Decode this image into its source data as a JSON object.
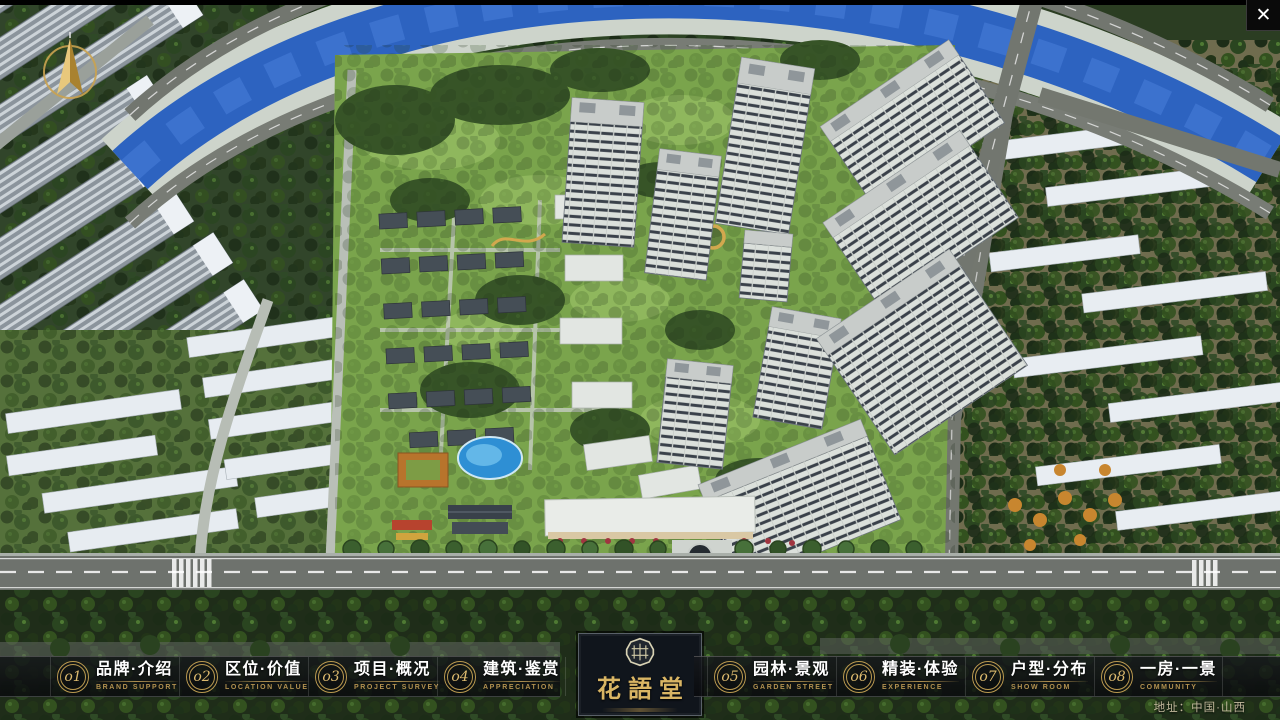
{
  "window": {
    "close_glyph": "✕"
  },
  "logo": {
    "title": "花語堂"
  },
  "nav": {
    "items": [
      {
        "num": "o1",
        "zh": "品牌·介绍",
        "en": "BRAND SUPPORT"
      },
      {
        "num": "o2",
        "zh": "区位·价值",
        "en": "LOCATION VALUE"
      },
      {
        "num": "o3",
        "zh": "项目·概况",
        "en": "PROJECT SURVEY"
      },
      {
        "num": "o4",
        "zh": "建筑·鉴赏",
        "en": "APPRECIATION"
      },
      {
        "num": "o5",
        "zh": "园林·景观",
        "en": "GARDEN STREET"
      },
      {
        "num": "o6",
        "zh": "精装·体验",
        "en": "EXPERIENCE"
      },
      {
        "num": "o7",
        "zh": "户型·分布",
        "en": "SHOW ROOM"
      },
      {
        "num": "o8",
        "zh": "一房·一景",
        "en": "COMMUNITY"
      }
    ]
  },
  "footer": {
    "address": "地址：中国·山西"
  },
  "scene": {
    "description": "Aerial 3D masterplan render: river at top, high-rise residential towers in landscaped community, slab buildings left and right, main road at bottom"
  },
  "colors": {
    "accent_gold": "#c9a45a",
    "nav_text": "#ffffff",
    "nav_english": "#b2914f",
    "bar_background": "rgba(12,14,18,0.78)",
    "river_blue": "#2d63c0",
    "lawn_green": "#7aa44c"
  }
}
